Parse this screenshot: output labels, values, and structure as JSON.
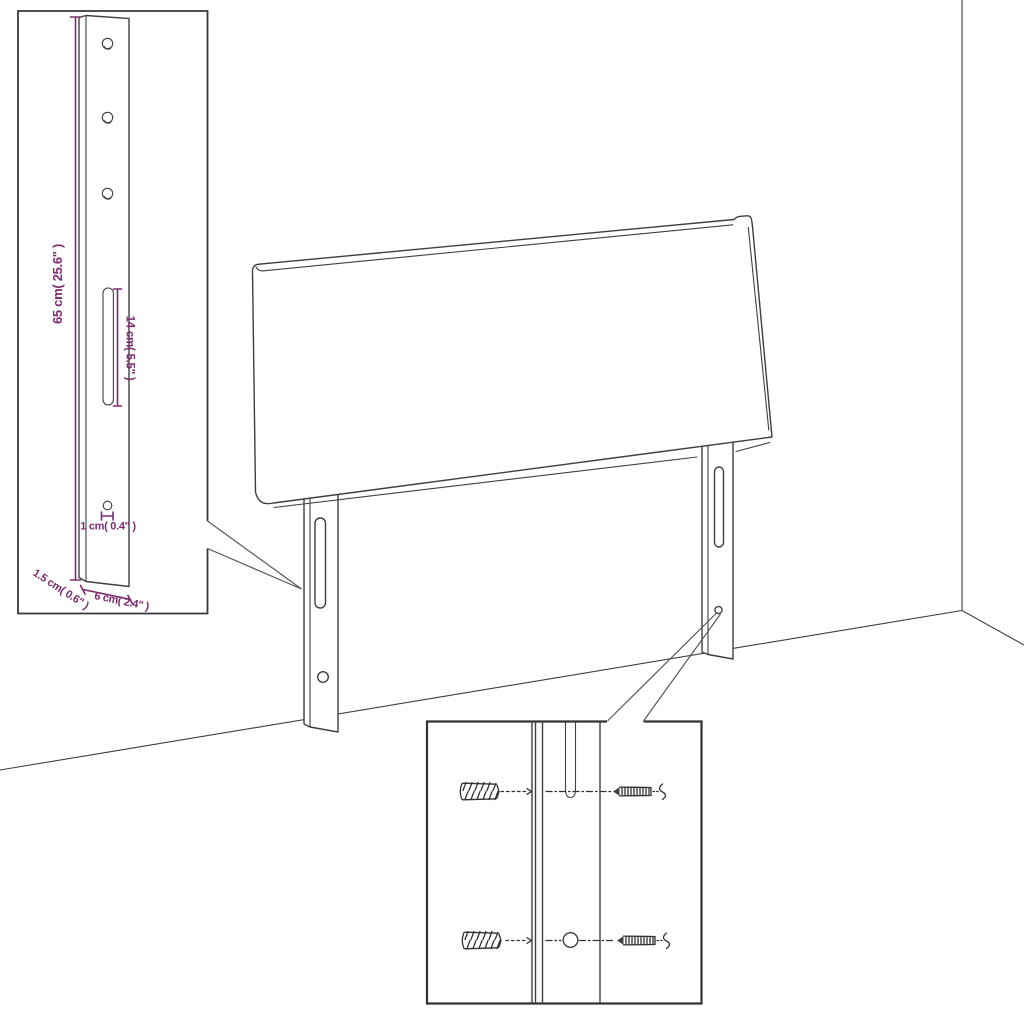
{
  "page": {
    "background": "#ffffff"
  },
  "colors": {
    "line": "#3f3f3f",
    "dimension_accent": "#7D2B6E"
  },
  "leg_detail_inset": {
    "labels": {
      "height": "65 cm( 25.6\" )",
      "slot_length": "14 cm( 5.5\" )",
      "hole_diameter": "1 cm( 0.4\" )",
      "edge_thickness": "1.5 cm( 0.6\" )",
      "leg_width": "6 cm( 2.4\" )"
    }
  },
  "mounting_detail_inset": {
    "hardware_icons": [
      "wall-plug-icon",
      "screw-icon",
      "wall-plug-icon",
      "screw-icon"
    ]
  }
}
